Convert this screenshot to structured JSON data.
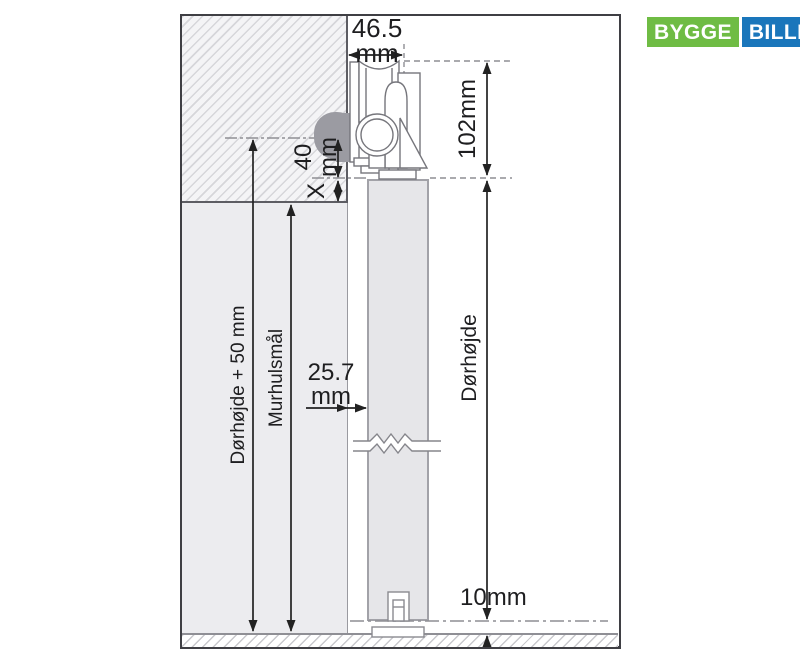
{
  "brand": {
    "bygge": "BYGGE",
    "billigt": "BILLIGT",
    "green": "#6fbc44",
    "blue": "#1a76bb"
  },
  "dims": {
    "track_width": {
      "value": "46.5",
      "unit": "mm"
    },
    "fitting_height": {
      "value": "102mm"
    },
    "rail_drop": {
      "value": "40",
      "unit": "mm"
    },
    "overlap": {
      "value": "X"
    },
    "wall_to_door": {
      "value": "25.7",
      "unit": "mm"
    },
    "floor_gap": {
      "value": "10mm"
    },
    "door_height_plus_50": {
      "label": "Dørhøjde + 50 mm"
    },
    "wall_opening": {
      "label": "Murhulsmål"
    },
    "door_height": {
      "label": "Dørhøjde"
    }
  },
  "colors": {
    "ink": "#222222",
    "frame": "#3f3f44",
    "wall_hatch_line": "#d6d6da",
    "wall_hatch_bg": "#f4f4f6",
    "opening_fill": "#ececef",
    "door_fill": "#e6e6e9",
    "door_edge": "#a2a2a8",
    "bracket_blob": "#9b9ba2",
    "dash_line": "#8e8e94"
  }
}
